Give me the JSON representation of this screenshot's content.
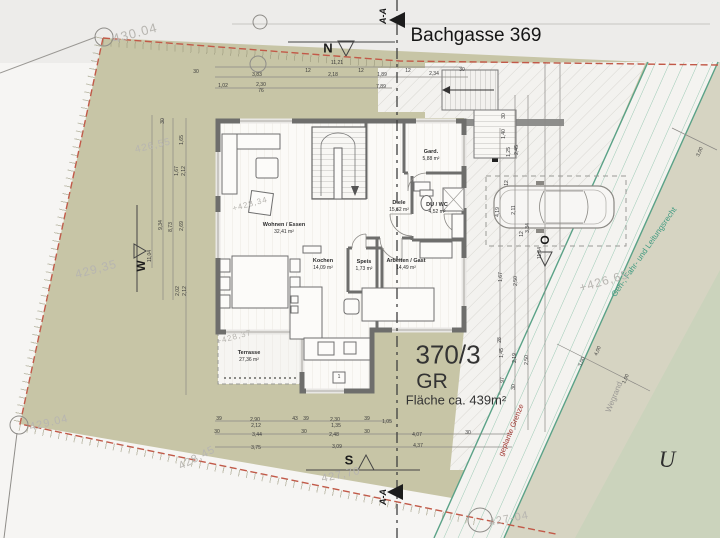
{
  "labels": {
    "street": "Bachgasse 369",
    "parcel_number": "370/3",
    "parcel_type": "GR",
    "parcel_area": "Fläche ca. 439m²",
    "neighbor": "U",
    "section_top": "A-A",
    "section_bottom": "A-A",
    "compass_n": "N",
    "compass_s": "S",
    "compass_w": "W",
    "compass_o": "O",
    "easement": "Geh-, Fahr- und Leitungsrecht",
    "path_edge": "Wegrand",
    "planned_boundary": "geplante Grenze"
  },
  "rooms": [
    {
      "name": "Wohnen / Essen",
      "area": "32,41 m²",
      "x": 284,
      "y": 229
    },
    {
      "name": "Kochen",
      "area": "14,09 m²",
      "x": 323,
      "y": 265
    },
    {
      "name": "Speis",
      "area": "1,73 m²",
      "x": 364,
      "y": 266
    },
    {
      "name": "Arbeiten / Gast",
      "area": "14,49 m²",
      "x": 406,
      "y": 265
    },
    {
      "name": "Diele",
      "area": "15,62 m²",
      "x": 399,
      "y": 207
    },
    {
      "name": "DU / WC",
      "area": "4,52 m²",
      "x": 437,
      "y": 209
    },
    {
      "name": "Gard.",
      "area": "5,88 m²",
      "x": 431,
      "y": 156
    },
    {
      "name": "Terrasse",
      "area": "27,36 m²",
      "x": 249,
      "y": 357
    }
  ],
  "survey_points": [
    {
      "t": "430.04",
      "x": 135,
      "y": 33,
      "r": -15,
      "s": 13
    },
    {
      "t": "426,55",
      "x": 153,
      "y": 146,
      "r": -13,
      "s": 10
    },
    {
      "t": "429,35",
      "x": 96,
      "y": 269,
      "r": -15,
      "s": 12
    },
    {
      "t": "+428,34",
      "x": 250,
      "y": 204,
      "r": -15,
      "s": 8
    },
    {
      "t": "+428,37",
      "x": 234,
      "y": 337,
      "r": -15,
      "s": 8
    },
    {
      "t": "428,45",
      "x": 197,
      "y": 458,
      "r": -27,
      "s": 11
    },
    {
      "t": "429.04",
      "x": 49,
      "y": 423,
      "r": -13,
      "s": 11
    },
    {
      "t": "427,70",
      "x": 341,
      "y": 475,
      "r": -12,
      "s": 11
    },
    {
      "t": "+426,65",
      "x": 604,
      "y": 281,
      "r": -16,
      "s": 12
    },
    {
      "t": "427-04",
      "x": 509,
      "y": 519,
      "r": -11,
      "s": 11
    }
  ],
  "dim_labels": [
    {
      "t": "11,21",
      "x": 337,
      "y": 63
    },
    {
      "t": "30",
      "x": 196,
      "y": 72
    },
    {
      "t": "3,83",
      "x": 257,
      "y": 75
    },
    {
      "t": "12",
      "x": 308,
      "y": 71
    },
    {
      "t": "2,18",
      "x": 333,
      "y": 75
    },
    {
      "t": "12",
      "x": 361,
      "y": 71
    },
    {
      "t": "1,89",
      "x": 382,
      "y": 75
    },
    {
      "t": "12",
      "x": 408,
      "y": 71
    },
    {
      "t": "2,34",
      "x": 434,
      "y": 74
    },
    {
      "t": "30",
      "x": 462,
      "y": 70
    },
    {
      "t": "1,02",
      "x": 223,
      "y": 86
    },
    {
      "t": "2,30",
      "x": 261,
      "y": 85
    },
    {
      "t": "76",
      "x": 261,
      "y": 91
    },
    {
      "t": "7,89",
      "x": 381,
      "y": 87
    },
    {
      "t": "30",
      "x": 163,
      "y": 121,
      "r": -90
    },
    {
      "t": "1,65",
      "x": 182,
      "y": 140,
      "r": -90
    },
    {
      "t": "1,67",
      "x": 177,
      "y": 171,
      "r": -90
    },
    {
      "t": "2,12",
      "x": 184,
      "y": 171,
      "r": -90
    },
    {
      "t": "2,69",
      "x": 182,
      "y": 226,
      "r": -90
    },
    {
      "t": "9,34",
      "x": 161,
      "y": 225,
      "r": -90
    },
    {
      "t": "8,73",
      "x": 171,
      "y": 227,
      "r": -90
    },
    {
      "t": "11,04",
      "x": 150,
      "y": 256,
      "r": -90
    },
    {
      "t": "2,02",
      "x": 178,
      "y": 291,
      "r": -90
    },
    {
      "t": "2,12",
      "x": 185,
      "y": 291,
      "r": -90
    },
    {
      "t": "39",
      "x": 219,
      "y": 419
    },
    {
      "t": "2,90",
      "x": 255,
      "y": 420
    },
    {
      "t": "2,12",
      "x": 256,
      "y": 426
    },
    {
      "t": "43",
      "x": 295,
      "y": 419
    },
    {
      "t": "39",
      "x": 306,
      "y": 419
    },
    {
      "t": "2,30",
      "x": 335,
      "y": 420
    },
    {
      "t": "1,35",
      "x": 336,
      "y": 426
    },
    {
      "t": "39",
      "x": 367,
      "y": 419
    },
    {
      "t": "1,05",
      "x": 387,
      "y": 422
    },
    {
      "t": "30",
      "x": 217,
      "y": 432
    },
    {
      "t": "3,44",
      "x": 257,
      "y": 435
    },
    {
      "t": "30",
      "x": 304,
      "y": 432
    },
    {
      "t": "2,48",
      "x": 334,
      "y": 435
    },
    {
      "t": "30",
      "x": 367,
      "y": 432
    },
    {
      "t": "4,07",
      "x": 417,
      "y": 435
    },
    {
      "t": "30",
      "x": 468,
      "y": 433
    },
    {
      "t": "3,75",
      "x": 256,
      "y": 448
    },
    {
      "t": "3,09",
      "x": 337,
      "y": 447
    },
    {
      "t": "4,37",
      "x": 418,
      "y": 446
    },
    {
      "t": "30",
      "x": 504,
      "y": 116,
      "r": -90
    },
    {
      "t": "1,40",
      "x": 504,
      "y": 134,
      "r": -90
    },
    {
      "t": "1,25",
      "x": 509,
      "y": 152,
      "r": -90
    },
    {
      "t": "2,45",
      "x": 517,
      "y": 150,
      "r": -90
    },
    {
      "t": "12",
      "x": 507,
      "y": 183,
      "r": -90
    },
    {
      "t": "4,19",
      "x": 498,
      "y": 212,
      "r": -90
    },
    {
      "t": "2,11",
      "x": 514,
      "y": 210,
      "r": -90
    },
    {
      "t": "3,34",
      "x": 528,
      "y": 228,
      "r": -90
    },
    {
      "t": "12",
      "x": 522,
      "y": 234,
      "r": -90
    },
    {
      "t": "11,84",
      "x": 540,
      "y": 253,
      "r": -90
    },
    {
      "t": "1,67",
      "x": 501,
      "y": 277,
      "r": -90
    },
    {
      "t": "2,50",
      "x": 516,
      "y": 281,
      "r": -90
    },
    {
      "t": "28",
      "x": 500,
      "y": 340,
      "r": -90
    },
    {
      "t": "1,45",
      "x": 502,
      "y": 353,
      "r": -90
    },
    {
      "t": "2,19",
      "x": 515,
      "y": 358,
      "r": -90
    },
    {
      "t": "2,50",
      "x": 527,
      "y": 360,
      "r": -90
    },
    {
      "t": "97",
      "x": 503,
      "y": 380,
      "r": -90
    },
    {
      "t": "30",
      "x": 514,
      "y": 387,
      "r": -90
    },
    {
      "t": "3,00",
      "x": 700,
      "y": 152,
      "r": -66
    },
    {
      "t": "4,00",
      "x": 598,
      "y": 351,
      "r": -66
    },
    {
      "t": "3,00",
      "x": 582,
      "y": 362,
      "r": -66
    },
    {
      "t": "1,00",
      "x": 626,
      "y": 379,
      "r": -66
    },
    {
      "t": "1",
      "x": 339,
      "y": 377
    }
  ],
  "colors": {
    "plot_fill": "#c7c5a6",
    "street_fill": "#edecea",
    "page": "#f6f5f3",
    "boundary_red": "#c25948",
    "easement_green": "#57a287",
    "strip_hatch": "#8fc2ab",
    "survey_gray": "#b7b5b0",
    "wall_gray": "#6e6e6c",
    "planned_boundary_red": "#a23b35"
  }
}
